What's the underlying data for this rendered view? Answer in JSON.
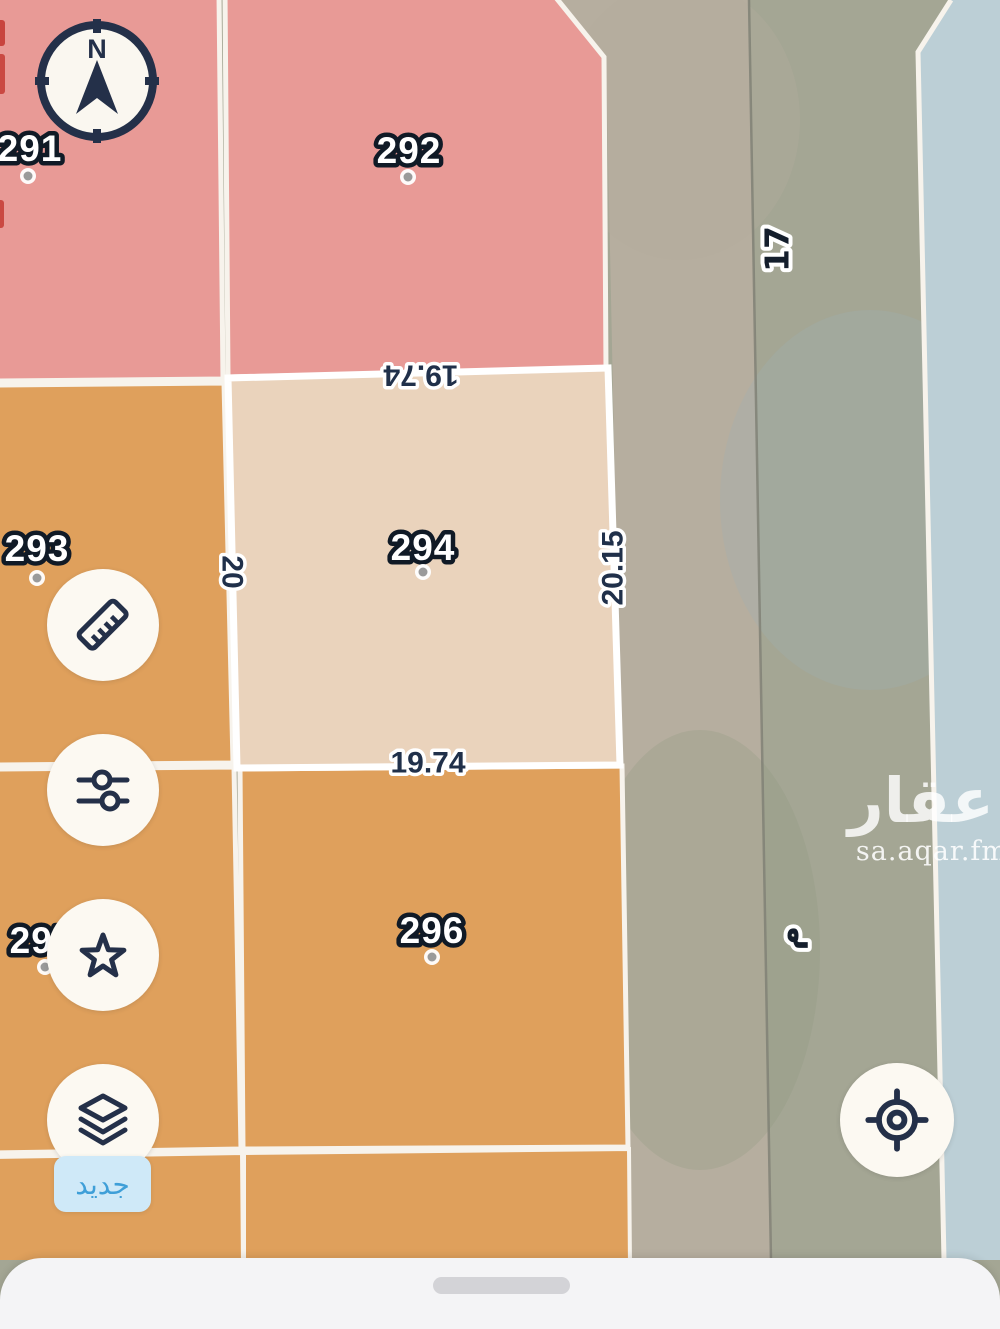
{
  "colors": {
    "plot_pink": "#e89a96",
    "plot_orange": "#dfa05c",
    "plot_selected": "#ead3bc",
    "plot_blue": "#bccfd6",
    "street": "#a4a694",
    "street_side": "#b6ae9f",
    "border": "#f7f3ec",
    "selected_border": "#ffffff",
    "ink": "#243049",
    "badge_bg": "#cfe9f8",
    "badge_text": "#3f9fd8"
  },
  "compass": {
    "north_label": "N"
  },
  "plots": {
    "p291": {
      "label": "291"
    },
    "p292": {
      "label": "292"
    },
    "p293": {
      "label": "293"
    },
    "p294": {
      "label": "294"
    },
    "p295": {
      "label": "295"
    },
    "p296": {
      "label": "296"
    }
  },
  "selected_plot": {
    "number": "294",
    "dim_top": "19.74",
    "dim_bottom": "19.74",
    "dim_left": "20",
    "dim_right": "20.15"
  },
  "street": {
    "number": "17",
    "unit_label": "م"
  },
  "toolbar": {
    "buttons": [
      {
        "icon": "ruler-icon"
      },
      {
        "icon": "filters-icon"
      },
      {
        "icon": "star-icon"
      },
      {
        "icon": "layers-icon",
        "badge": "جديد"
      }
    ]
  },
  "locate_button": {
    "icon": "crosshair-icon"
  },
  "watermark": {
    "brand": "عقار",
    "site": "sa.aqar.fm"
  }
}
